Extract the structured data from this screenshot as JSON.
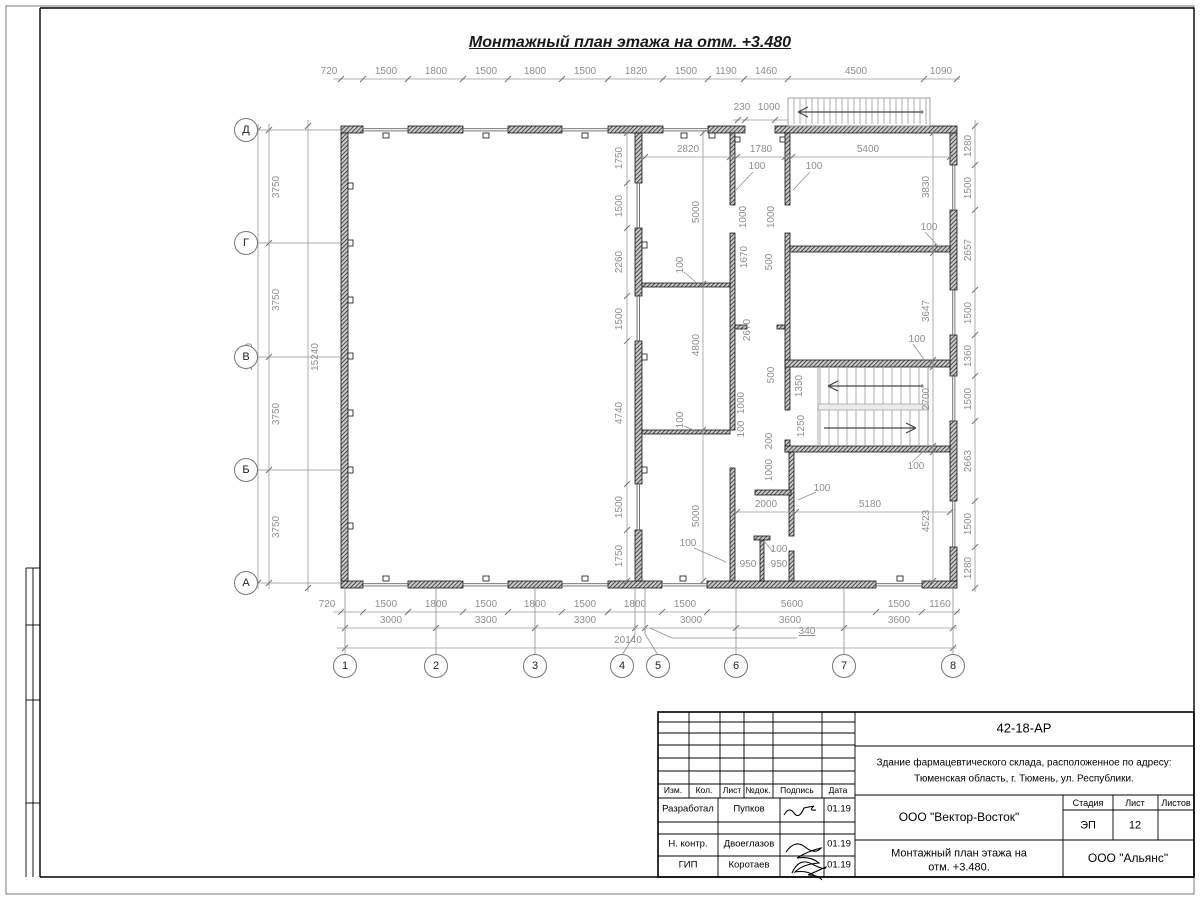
{
  "page_title": "Монтажный план этажа на отм. +3.480",
  "axes": {
    "bottom": [
      {
        "label": "1",
        "x": 345
      },
      {
        "label": "2",
        "x": 436
      },
      {
        "label": "3",
        "x": 535
      },
      {
        "label": "4",
        "x": 622
      },
      {
        "label": "5",
        "x": 658
      },
      {
        "label": "6",
        "x": 736
      },
      {
        "label": "7",
        "x": 844
      },
      {
        "label": "8",
        "x": 953
      }
    ],
    "left": [
      {
        "label": "Д",
        "y": 130
      },
      {
        "label": "Г",
        "y": 243
      },
      {
        "label": "В",
        "y": 357
      },
      {
        "label": "Б",
        "y": 470
      },
      {
        "label": "А",
        "y": 583
      }
    ]
  },
  "dimensions": [
    {
      "t": "720",
      "x": 329,
      "y": 72
    },
    {
      "t": "1500",
      "x": 386,
      "y": 72
    },
    {
      "t": "1800",
      "x": 436,
      "y": 72
    },
    {
      "t": "1500",
      "x": 486,
      "y": 72
    },
    {
      "t": "1800",
      "x": 535,
      "y": 72
    },
    {
      "t": "1500",
      "x": 585,
      "y": 72
    },
    {
      "t": "1820",
      "x": 636,
      "y": 72
    },
    {
      "t": "1500",
      "x": 686,
      "y": 72
    },
    {
      "t": "1190",
      "x": 726,
      "y": 72
    },
    {
      "t": "1460",
      "x": 766,
      "y": 72
    },
    {
      "t": "4500",
      "x": 856,
      "y": 72
    },
    {
      "t": "1090",
      "x": 941,
      "y": 72
    },
    {
      "t": "230",
      "x": 742,
      "y": 108
    },
    {
      "t": "1000",
      "x": 769,
      "y": 108
    },
    {
      "t": "3750",
      "x": 277,
      "y": 187,
      "r": 1
    },
    {
      "t": "3750",
      "x": 277,
      "y": 300,
      "r": 1
    },
    {
      "t": "3750",
      "x": 277,
      "y": 414,
      "r": 1
    },
    {
      "t": "3750",
      "x": 277,
      "y": 527,
      "r": 1
    },
    {
      "t": "15000",
      "x": 250,
      "y": 357,
      "r": 1
    },
    {
      "t": "15240",
      "x": 316,
      "y": 357,
      "r": 1
    },
    {
      "t": "1280",
      "x": 969,
      "y": 146,
      "r": 1
    },
    {
      "t": "1500",
      "x": 969,
      "y": 188,
      "r": 1
    },
    {
      "t": "2657",
      "x": 969,
      "y": 250,
      "r": 1
    },
    {
      "t": "1500",
      "x": 969,
      "y": 313,
      "r": 1
    },
    {
      "t": "1360",
      "x": 969,
      "y": 356,
      "r": 1
    },
    {
      "t": "1500",
      "x": 969,
      "y": 399,
      "r": 1
    },
    {
      "t": "2663",
      "x": 969,
      "y": 461,
      "r": 1
    },
    {
      "t": "1500",
      "x": 969,
      "y": 524,
      "r": 1
    },
    {
      "t": "1280",
      "x": 969,
      "y": 568,
      "r": 1
    },
    {
      "t": "720",
      "x": 327,
      "y": 605
    },
    {
      "t": "1500",
      "x": 386,
      "y": 605
    },
    {
      "t": "1800",
      "x": 436,
      "y": 605
    },
    {
      "t": "1500",
      "x": 486,
      "y": 605
    },
    {
      "t": "1800",
      "x": 535,
      "y": 605
    },
    {
      "t": "1500",
      "x": 585,
      "y": 605
    },
    {
      "t": "1800",
      "x": 635,
      "y": 605
    },
    {
      "t": "1500",
      "x": 685,
      "y": 605
    },
    {
      "t": "5600",
      "x": 792,
      "y": 605
    },
    {
      "t": "1500",
      "x": 899,
      "y": 605
    },
    {
      "t": "1160",
      "x": 940,
      "y": 605
    },
    {
      "t": "3000",
      "x": 391,
      "y": 621
    },
    {
      "t": "3300",
      "x": 486,
      "y": 621
    },
    {
      "t": "3300",
      "x": 585,
      "y": 621
    },
    {
      "t": "3000",
      "x": 691,
      "y": 621
    },
    {
      "t": "3600",
      "x": 790,
      "y": 621
    },
    {
      "t": "3600",
      "x": 899,
      "y": 621
    },
    {
      "t": "340",
      "x": 807,
      "y": 632,
      "u": 1
    },
    {
      "t": "20140",
      "x": 628,
      "y": 641
    },
    {
      "t": "1750",
      "x": 620,
      "y": 158,
      "r": 1
    },
    {
      "t": "1500",
      "x": 620,
      "y": 206,
      "r": 1
    },
    {
      "t": "2260",
      "x": 620,
      "y": 262,
      "r": 1
    },
    {
      "t": "1500",
      "x": 620,
      "y": 319,
      "r": 1
    },
    {
      "t": "4740",
      "x": 620,
      "y": 413,
      "r": 1
    },
    {
      "t": "1500",
      "x": 620,
      "y": 507,
      "r": 1
    },
    {
      "t": "1750",
      "x": 620,
      "y": 556,
      "r": 1
    },
    {
      "t": "2820",
      "x": 688,
      "y": 150
    },
    {
      "t": "1780",
      "x": 761,
      "y": 150
    },
    {
      "t": "5400",
      "x": 868,
      "y": 150
    },
    {
      "t": "100",
      "x": 757,
      "y": 167
    },
    {
      "t": "100",
      "x": 814,
      "y": 167
    },
    {
      "t": "5000",
      "x": 697,
      "y": 212,
      "r": 1
    },
    {
      "t": "100",
      "x": 681,
      "y": 265,
      "r": 1
    },
    {
      "t": "4800",
      "x": 697,
      "y": 345,
      "r": 1
    },
    {
      "t": "100",
      "x": 681,
      "y": 420,
      "r": 1
    },
    {
      "t": "5000",
      "x": 697,
      "y": 516,
      "r": 1
    },
    {
      "t": "1670",
      "x": 745,
      "y": 257,
      "r": 1
    },
    {
      "t": "2670",
      "x": 748,
      "y": 330,
      "r": 1
    },
    {
      "t": "1000",
      "x": 744,
      "y": 217,
      "r": 1
    },
    {
      "t": "1000",
      "x": 772,
      "y": 217,
      "r": 1
    },
    {
      "t": "500",
      "x": 770,
      "y": 262,
      "r": 1
    },
    {
      "t": "500",
      "x": 772,
      "y": 375,
      "r": 1
    },
    {
      "t": "1350",
      "x": 800,
      "y": 386,
      "r": 1
    },
    {
      "t": "1250",
      "x": 802,
      "y": 426,
      "r": 1
    },
    {
      "t": "200",
      "x": 770,
      "y": 441,
      "r": 1
    },
    {
      "t": "1000",
      "x": 770,
      "y": 470,
      "r": 1
    },
    {
      "t": "1000",
      "x": 742,
      "y": 403,
      "r": 1
    },
    {
      "t": "100",
      "x": 742,
      "y": 429,
      "r": 1
    },
    {
      "t": "2000",
      "x": 766,
      "y": 505
    },
    {
      "t": "100",
      "x": 822,
      "y": 489
    },
    {
      "t": "5180",
      "x": 870,
      "y": 505
    },
    {
      "t": "100",
      "x": 688,
      "y": 544
    },
    {
      "t": "100",
      "x": 779,
      "y": 550
    },
    {
      "t": "950",
      "x": 748,
      "y": 565
    },
    {
      "t": "950",
      "x": 779,
      "y": 565
    },
    {
      "t": "3830",
      "x": 927,
      "y": 187,
      "r": 1
    },
    {
      "t": "100",
      "x": 929,
      "y": 228
    },
    {
      "t": "3647",
      "x": 927,
      "y": 311,
      "r": 1
    },
    {
      "t": "100",
      "x": 917,
      "y": 340
    },
    {
      "t": "2700",
      "x": 927,
      "y": 399,
      "r": 1
    },
    {
      "t": "100",
      "x": 916,
      "y": 467
    },
    {
      "t": "4523",
      "x": 927,
      "y": 521,
      "r": 1
    }
  ],
  "title_block": {
    "doc_number": "42-18-АР",
    "address_line1": "Здание фармацевтического склада, расположенное по адресу:",
    "address_line2": "Тюменская область, г. Тюмень, ул. Республики.",
    "header_cols": [
      "Изм.",
      "Кол.",
      "Лист",
      "№док.",
      "Подпись",
      "Дата"
    ],
    "rows": [
      {
        "role": "Разработал",
        "name": "Пупков",
        "date": "01.19"
      },
      {
        "role": "Н. контр.",
        "name": "Двоеглазов",
        "date": "01.19"
      },
      {
        "role": "ГИП",
        "name": "Коротаев",
        "date": "01.19"
      }
    ],
    "org": "ООО \"Вектор-Восток\"",
    "stage_label": "Стадия",
    "sheet_label": "Лист",
    "sheets_label": "Листов",
    "stage": "ЭП",
    "sheet": "12",
    "drawing_title_line1": "Монтажный план этажа на",
    "drawing_title_line2": "отм. +3.480.",
    "client": "ООО \"Альянс\""
  }
}
